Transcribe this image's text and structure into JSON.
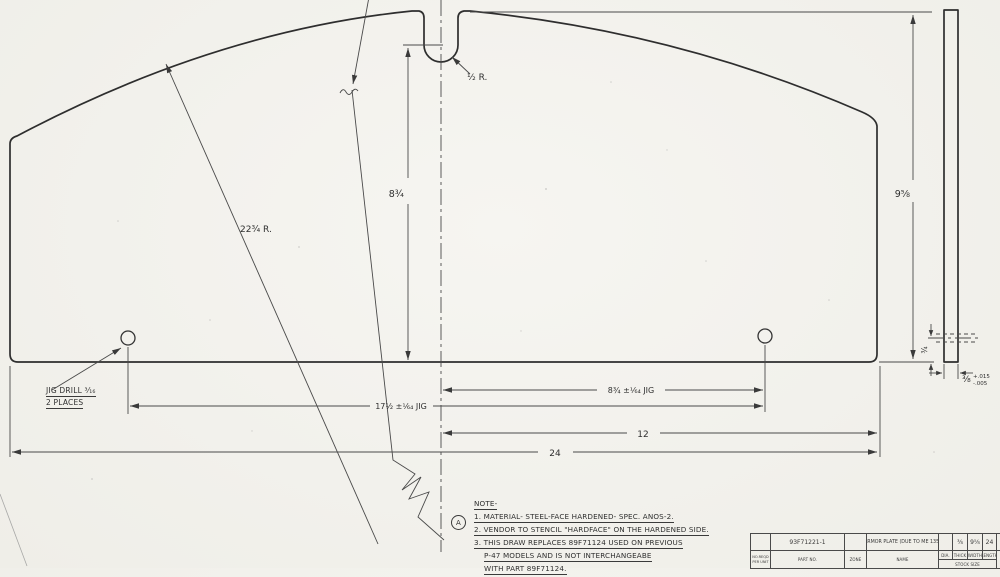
{
  "drawing": {
    "dims": {
      "height_to_notch": "8¾",
      "plate_height": "9⅝",
      "top_arc_radius": "22¾ R.",
      "notch_radius": "½ R.",
      "center_to_hole": "8¾ ±¹⁄₆₄ JIG",
      "hole_to_hole": "17½ ±¹⁄₆₄ JIG",
      "center_to_edge": "12",
      "plate_length": "24",
      "hole_to_bottom_edge": "¾",
      "thickness": "⅜",
      "thickness_tol_plus": "+.015",
      "thickness_tol_minus": "-.005"
    },
    "jig_note": {
      "line1": "JIG DRILL ³⁄₁₆",
      "line2": "2 PLACES"
    },
    "notes": {
      "heading": "NOTE-",
      "flag": "A",
      "line1": "1. MATERIAL- STEEL-FACE HARDENED- SPEC. ANOS-2.",
      "line2": "2. VENDOR TO STENCIL \"HARDFACE\" ON THE HARDENED SIDE.",
      "line3": "3. THIS DRAW REPLACES 89F71124 USED ON PREVIOUS",
      "line4": "P-47 MODELS AND IS NOT INTERCHANGEABE",
      "line5": "WITH PART 89F71124."
    },
    "title_block": {
      "req_label_1": "NO.REQD",
      "req_label_2": "PER UNIT",
      "part_no_label": "PART NO.",
      "part_no": "93F71221-1",
      "zone_label": "ZONE",
      "zone": "",
      "name_label": "NAME",
      "name": "ARMOR PLATE (DUE TO ME 135)",
      "dia_label": "DIA.",
      "dia": "",
      "thick_label": "THICK",
      "thick": "⅜",
      "width_label": "WIDTH",
      "width": "9⅝",
      "length_label": "LENGTH",
      "length": "24",
      "stock_size_label": "STOCK SIZE",
      "overflow_value": "NO"
    }
  }
}
